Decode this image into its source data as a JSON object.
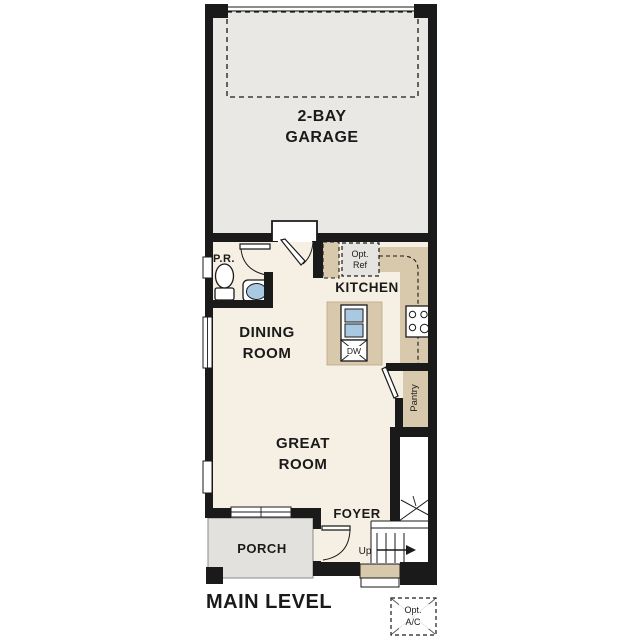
{
  "plan_title": "MAIN LEVEL",
  "rooms": {
    "garage": {
      "line1": "2-BAY",
      "line2": "GARAGE"
    },
    "kitchen": {
      "label": "KITCHEN"
    },
    "dining": {
      "line1": "DINING",
      "line2": "ROOM"
    },
    "great_room": {
      "line1": "GREAT",
      "line2": "ROOM"
    },
    "foyer": {
      "label": "FOYER"
    },
    "porch": {
      "label": "PORCH"
    },
    "powder_room": {
      "label": "P.R."
    },
    "pantry": {
      "label": "Pantry"
    }
  },
  "labels": {
    "up": "Up",
    "dishwasher": "DW",
    "opt_ref": {
      "line1": "Opt.",
      "line2": "Ref"
    },
    "opt_ac": {
      "line1": "Opt.",
      "line2": "A/C"
    }
  },
  "colors": {
    "paper": "#ffffff",
    "wall": "#1a1a1a",
    "floor": "#f6efe3",
    "garage": "#e9e8e5",
    "porch": "#e2e1de",
    "counter": "#d8c8ac",
    "optref": "#e6e4e1",
    "basin": "#a9c9e2"
  }
}
